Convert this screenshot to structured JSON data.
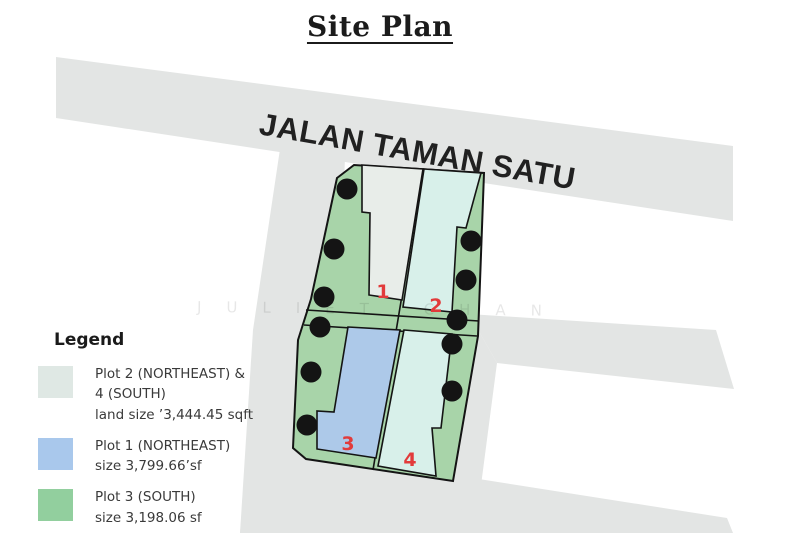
{
  "title": "Site Plan",
  "road_name": "JALAN TAMAN SATU",
  "watermark": "JULIET CHAN",
  "plot_labels": [
    "1",
    "2",
    "3",
    "4"
  ],
  "legend": {
    "heading": "Legend",
    "items": [
      {
        "swatch_color": "#dfe8e4",
        "lines": [
          "Plot 2 (NORTHEAST) &",
          "4 (SOUTH)",
          "land size ’3,444.45 sqft"
        ]
      },
      {
        "swatch_color": "#a9c8ec",
        "lines": [
          "Plot 1 (NORTHEAST)",
          "size 3,799.66’sf"
        ]
      },
      {
        "swatch_color": "#92cf9e",
        "lines": [
          "Plot 3 (SOUTH)",
          "size 3,198.06 sf"
        ]
      }
    ]
  },
  "colors": {
    "road_gray": "#e3e5e4",
    "estate_green": "#a8d4a9",
    "plot_gray": "#e8ede9",
    "plot_mint": "#d8f0ea",
    "plot_blue": "#adc9e9",
    "label_red": "#e23b3b",
    "tree_black": "#141414",
    "road_text": "#212121"
  }
}
